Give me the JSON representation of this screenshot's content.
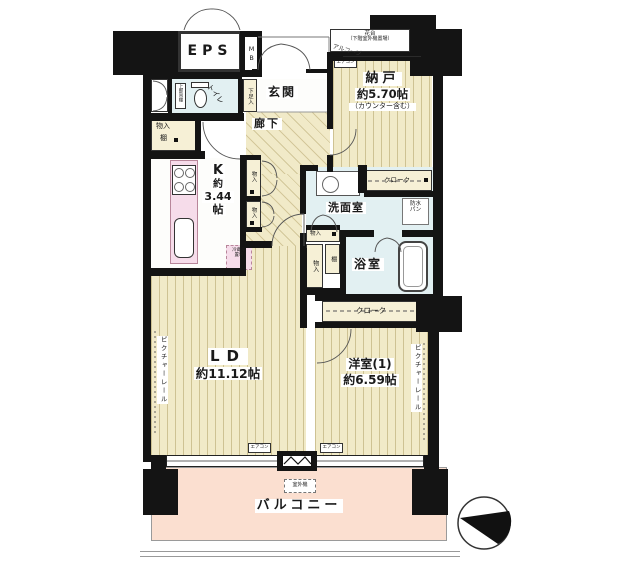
{
  "plan": {
    "labels": {
      "eps": "EPS",
      "mb": "MB",
      "alcove": "アルコーブ",
      "flower_stand": "花台",
      "flower_stand_note": "（下階室外機置場）",
      "entrance": "玄関",
      "shoe_cabinet": "下足入",
      "toilet": "トイレ",
      "toilet_upper_shelf": "上部吊棚",
      "closet": "物入",
      "shelf": "棚",
      "corridor": "廊下",
      "storage_room": "納戸",
      "storage_room_size": "約5.70帖",
      "storage_room_note": "（カウンター含む）",
      "cloak": "クローク",
      "kitchen_k": "K",
      "kitchen_about": "約",
      "kitchen_size": "3.44",
      "kitchen_unit": "帖",
      "fridge_line1": "冷蔵庫",
      "fridge_line2": "置場",
      "washroom": "洗面室",
      "waterproof_pan_line1": "防水",
      "waterproof_pan_line2": "パン",
      "bathroom": "浴室",
      "living_dining": "LD",
      "living_dining_size": "約11.12帖",
      "western_room": "洋室(1)",
      "western_room_size": "約6.59帖",
      "picture_rail": "ピクチャーレール",
      "aircon": "エアコン",
      "outdoor_unit": "室外機",
      "balcony": "バルコニー"
    },
    "colors": {
      "wall": "#141414",
      "wood_floor": "#f1eac8",
      "wet_floor": "#e2f0f2",
      "balcony_floor": "#fbdfd0",
      "kitchen_counter": "#f6dcea"
    }
  }
}
